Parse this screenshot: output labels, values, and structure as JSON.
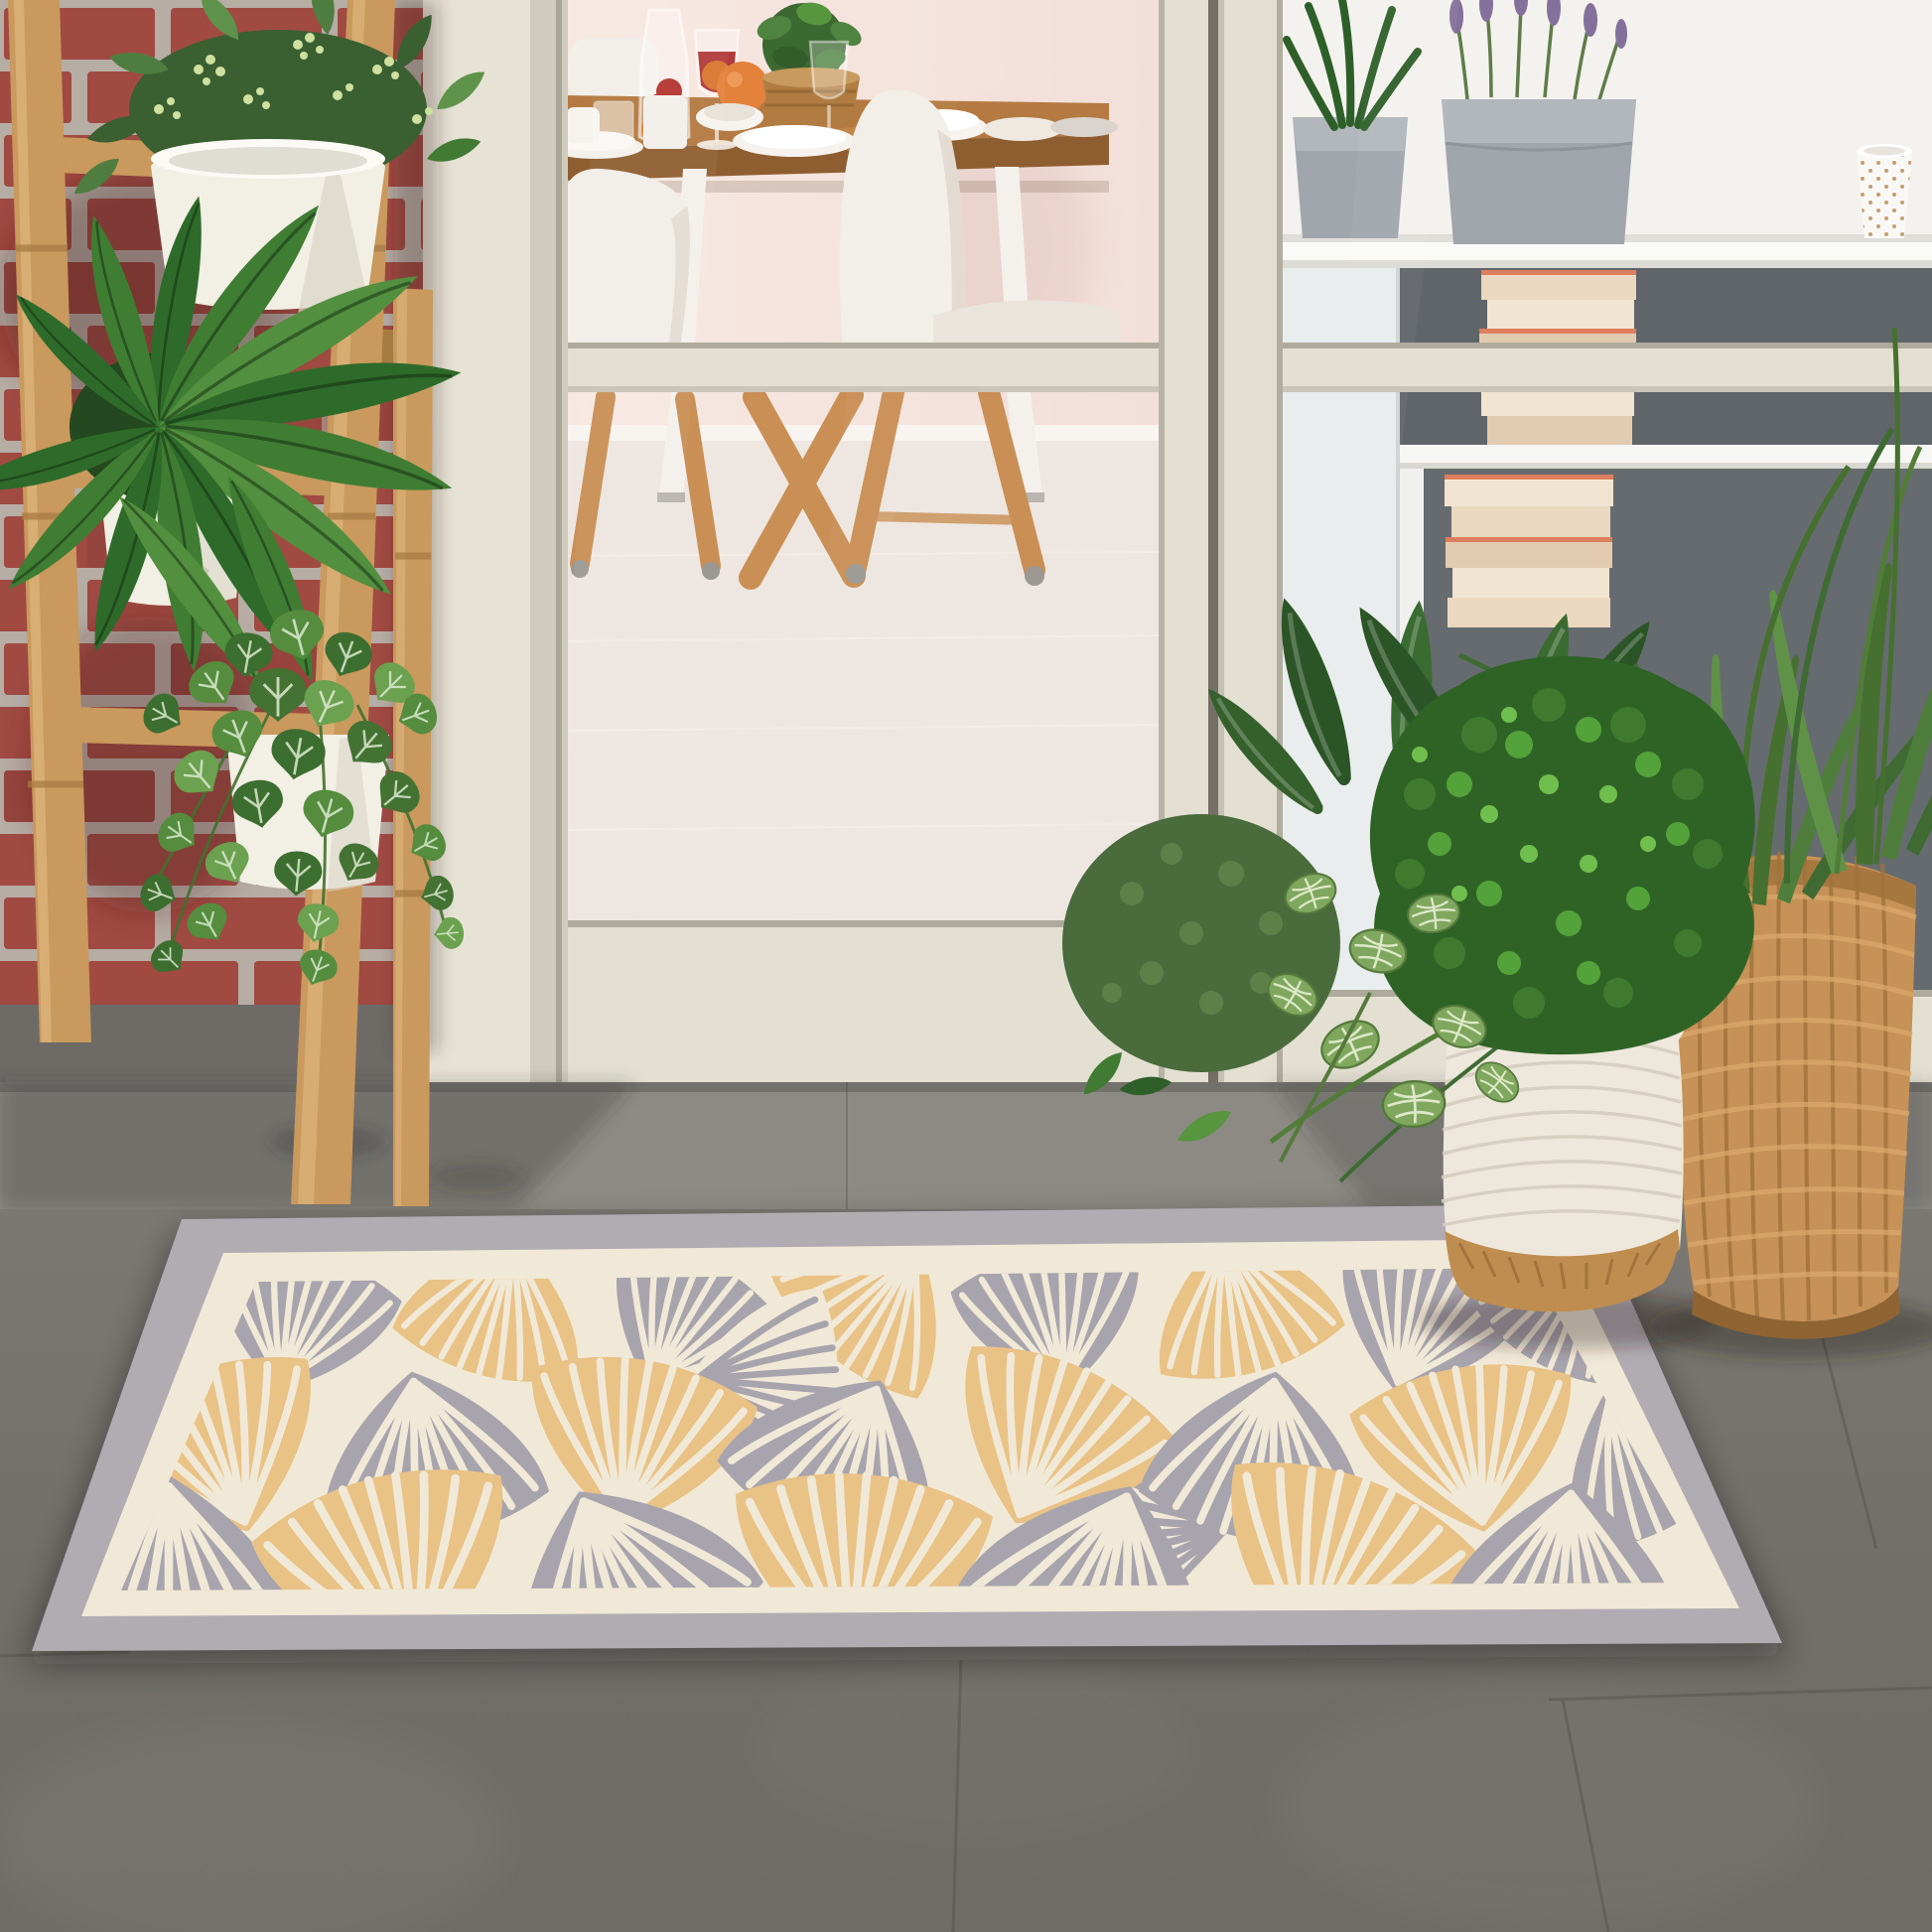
{
  "palette": {
    "brick": "#a04a42",
    "brick_dark": "#8a3f37",
    "brick_mortar": "#b6ada5",
    "cream_wall": "#e6e3d5",
    "cream_shadow": "#cfccbd",
    "door_cream": "#e3e0d2",
    "door_line": "#aeab9d",
    "door_gap": "#746f65",
    "room_wall_pink": "#f3dfd9",
    "room_wall_pink_lt": "#f7e8e2",
    "room_baseboard": "#f8f4ef",
    "room_floor": "#eee6e0",
    "table_wood": "#b47a41",
    "table_edge": "#8f5e30",
    "leg_white": "#f4f1ec",
    "leg_wood": "#c98f55",
    "chair_white": "#f2eee8",
    "chair_shade": "#ded5cc",
    "shelf_wall": "#f4f2ee",
    "shelf_white": "#fafaf7",
    "cubby_dark": "#60656a",
    "book_a": "#ead9c0",
    "book_b": "#f1e5d1",
    "book_c": "#e3cbb1",
    "book_coral": "#dd7f5e",
    "felt_grey": "#a0a6ab",
    "felt_light": "#b2b7bb",
    "lavender": "#84719b",
    "stem_green": "#5e7c48",
    "mug_white": "#faf8f4",
    "mug_dot": "#b98d62",
    "plant_deep": "#24481f",
    "plant_dark": "#2e5f29",
    "plant_mid": "#417a33",
    "plant_light": "#57953f",
    "plant_pale": "#6fae52",
    "fittonia": "#7fa85e",
    "fittonia_vein": "#e9f0d6",
    "berry": "#cfe0a0",
    "bamboo": "#c9995d",
    "bamboo_dark": "#a87b43",
    "bamboo_light": "#e2bd85",
    "pot_white": "#f2efe5",
    "pot_shade": "#d9d5c6",
    "step_grey": "#8d8a84",
    "floor_grey": "#75726d",
    "floor_dark": "#676560",
    "floor_light": "#8b8883",
    "grout": "#56544f",
    "rug_border": "#b1acb2",
    "rug_cream": "#f1e9d7",
    "rug_leaf_grey": "#a8a4ad",
    "rug_leaf_gold": "#e9c286",
    "rope_white": "#eee8dc",
    "rope_line": "#d5cec0",
    "jute": "#bf8d4f",
    "jute_dark": "#9c6f38",
    "wicker": "#c69257",
    "wicker_dark": "#a0733c",
    "wicker_light": "#dcab6d"
  }
}
